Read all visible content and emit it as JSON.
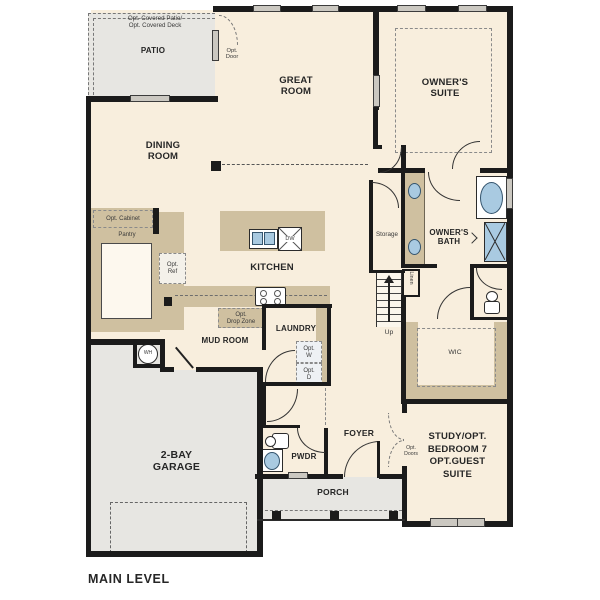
{
  "plan_title": "MAIN LEVEL",
  "labels": {
    "patio": "PATIO",
    "patio_note": "Opt. Covered Patio/\nOpt. Covered Deck",
    "opt_door": "Opt.\nDoor",
    "great_room": "GREAT\nROOM",
    "owners_suite": "OWNER'S\nSUITE",
    "dining_room": "DINING\nROOM",
    "opt_cabinet": "Opt. Cabinet",
    "pantry": "Pantry",
    "opt_ref": "Opt.\nRef",
    "kitchen": "KITCHEN",
    "dw": "DW",
    "opt_drop_zone": "Opt.\nDrop Zone",
    "mud_room": "MUD ROOM",
    "wh": "WH",
    "laundry": "LAUNDRY",
    "opt_w": "Opt.\nW",
    "opt_d": "Opt.\nD",
    "storage": "Storage",
    "up": "Up",
    "linen": "Linen",
    "owners_bath": "OWNER'S\nBATH",
    "wic": "WIC",
    "foyer": "FOYER",
    "opt_doors": "Opt.\nDoors",
    "pwdr": "PWDR",
    "study": "STUDY/OPT.\nBEDROOM 7\nOPT.GUEST\nSUITE",
    "garage": "2-BAY\nGARAGE",
    "porch": "PORCH"
  },
  "colors": {
    "floor": "#f8eedd",
    "outdoor": "#e7e6e2",
    "cabinet": "#cfc0a0",
    "fixture_blue": "#a9cae1",
    "wall": "#1b1b1b"
  }
}
